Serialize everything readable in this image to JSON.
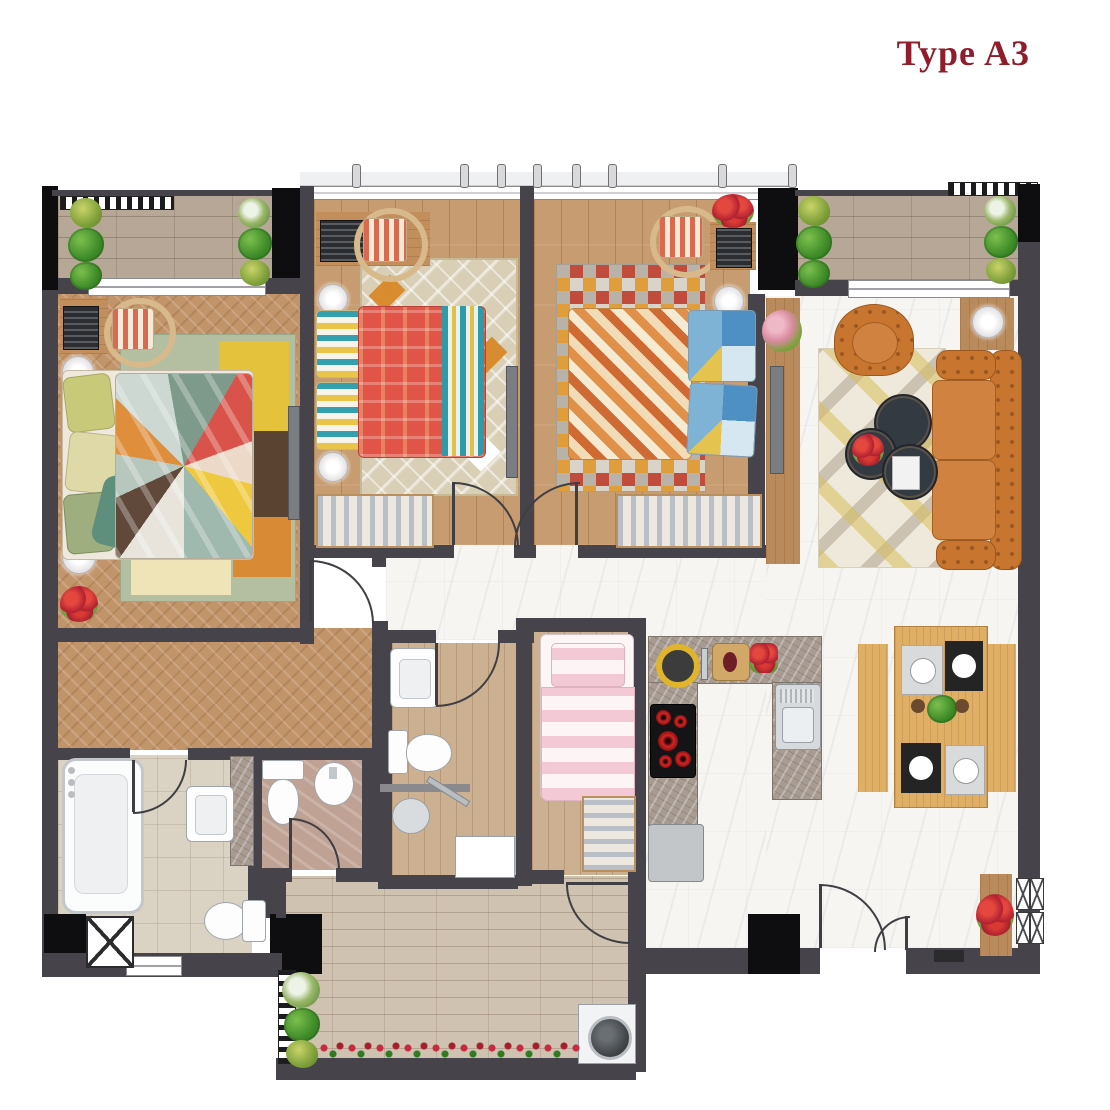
{
  "title": "Type A3",
  "palette": {
    "title_red": "#8f1d2c",
    "wall": "#46444a",
    "wall_black": "#0e0e10",
    "wood_floor": "#c2946a",
    "plank_floor": "#c69c70",
    "wood_tile": "#ccb092",
    "deck": "#b7a797",
    "brick": "#cfc2b0",
    "marble": "#f6f5f2",
    "bath_tile": "#dad2c2",
    "wc_tile": "#c0a295",
    "counter": "#a89c92",
    "sofa_orange": "#c8762f",
    "duvet_red": "#e05548"
  }
}
